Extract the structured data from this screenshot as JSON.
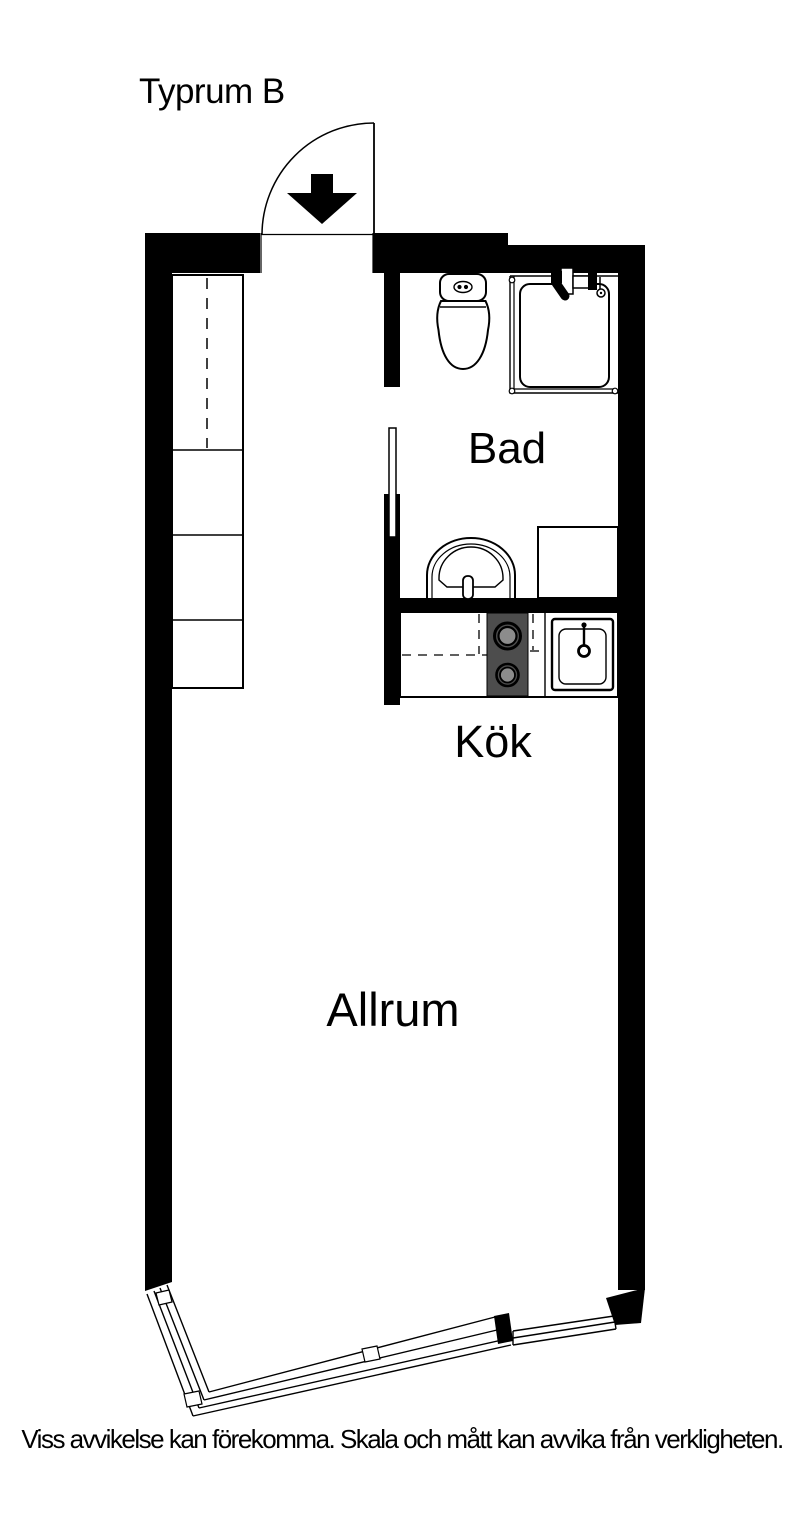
{
  "title": "Typrum B",
  "labels": {
    "bathroom": "Bad",
    "kitchen": "Kök",
    "living_room": "Allrum"
  },
  "footer": {
    "disclaimer": "Viss avvikelse kan förekomma. Skala och mått kan avvika från verkligheten."
  },
  "colors": {
    "line": "#000000",
    "wall": "#000000",
    "background": "#ffffff",
    "stove": "#4d4d4d",
    "burner": "#8c8c8c"
  }
}
